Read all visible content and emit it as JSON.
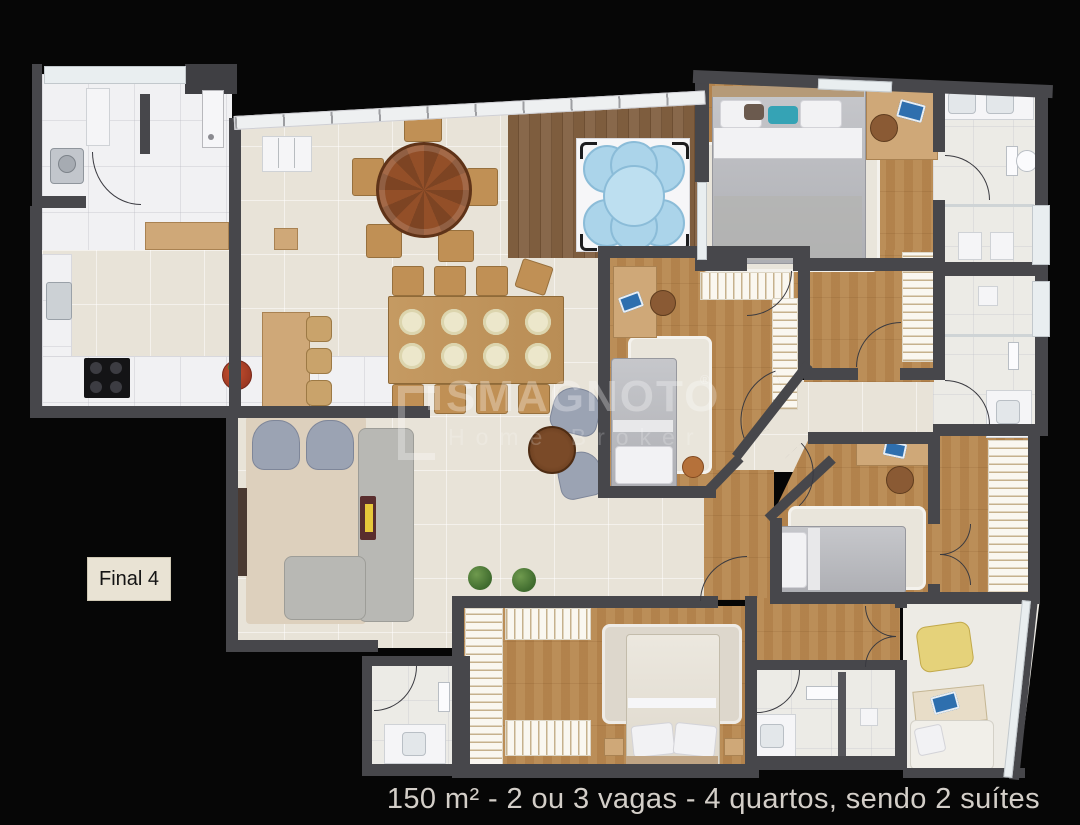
{
  "scene": {
    "type": "apartment-floor-plan",
    "unit_label": "Final 4",
    "caption": "150 m² - 2 ou 3 vagas - 4 quartos, sendo 2 suítes",
    "watermark": {
      "brand": "SMAGNOTO",
      "registered_mark": "®",
      "subtitle": "Home Broker"
    },
    "colors": {
      "background": "#060606",
      "wall": "#47474b",
      "tile_floor": "#e8e3d8",
      "wood_floor": "#d8bb92",
      "deck_wood": "#7a5939",
      "marble": "#f1f1f3",
      "spa_water": "#abd4ea",
      "label_bg": "#e9e3d4",
      "caption_text": "#d3cec8"
    }
  }
}
